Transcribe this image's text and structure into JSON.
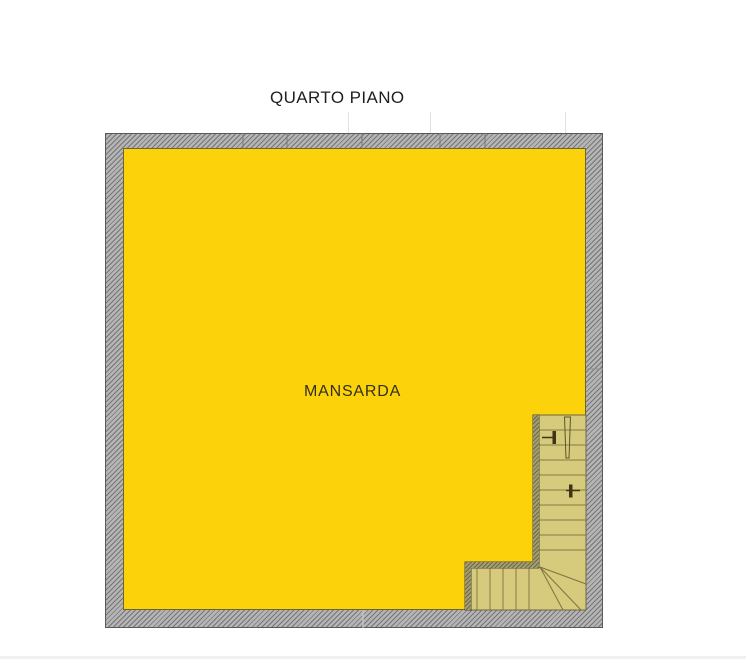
{
  "header": {
    "title": "QUARTO PIANO"
  },
  "plan": {
    "room_label": "MANSARDA",
    "colors": {
      "floor": "#fcd30b",
      "stair": "#d6ca7d",
      "wall_base": "#b5b5b5",
      "wall_hatch": "#757575",
      "inner_wall_base": "#a39d74",
      "inner_wall_hatch": "#6e6848",
      "title_text": "#1f1f1f",
      "label_text": "#33301a"
    }
  }
}
